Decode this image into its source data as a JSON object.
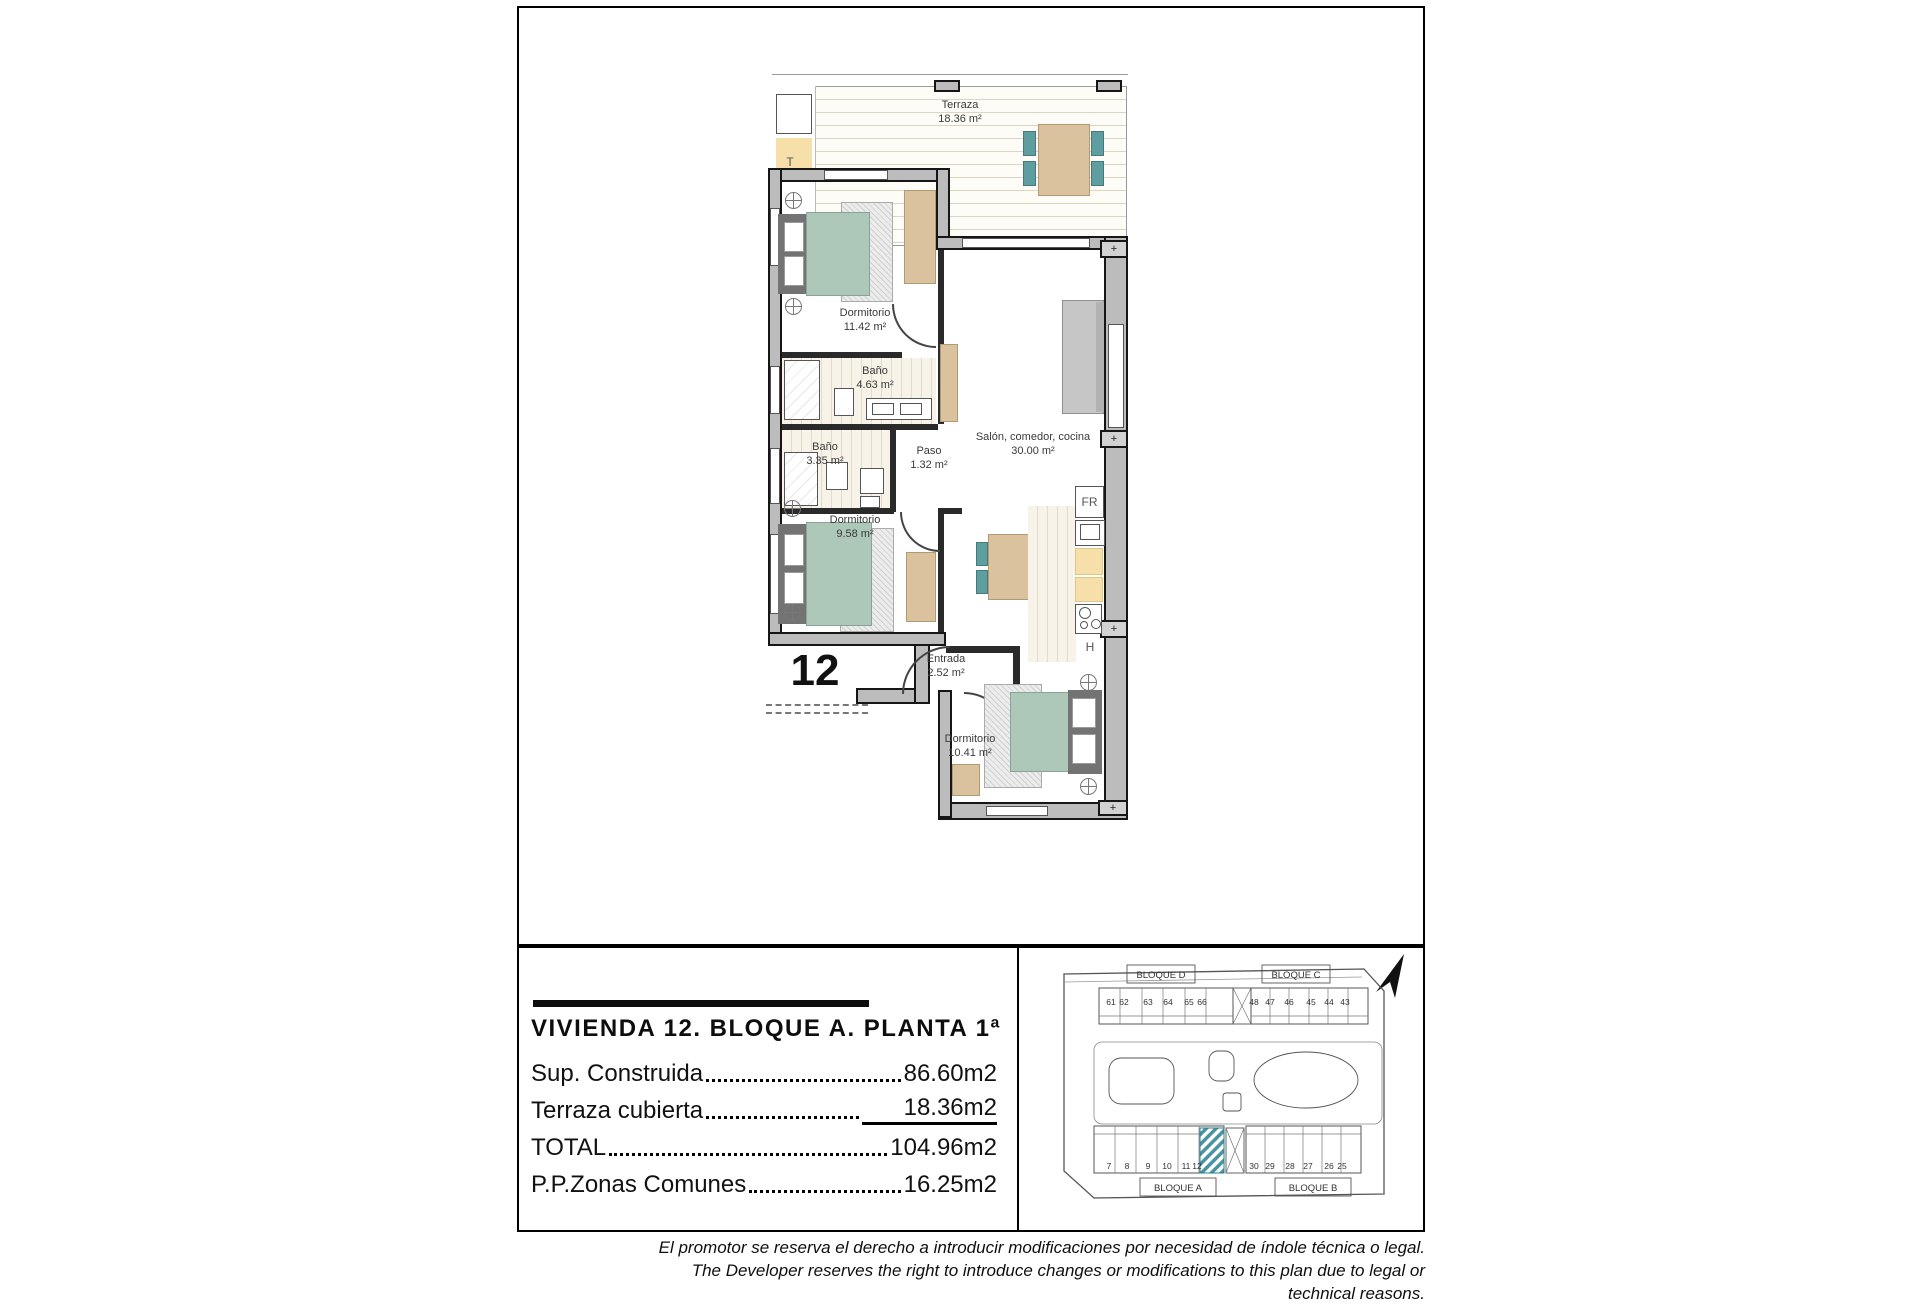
{
  "plan": {
    "unit_number": "12",
    "rooms": {
      "terraza": {
        "name": "Terraza",
        "area": "18.36 m²"
      },
      "dormitorio1": {
        "name": "Dormitorio",
        "area": "11.42 m²"
      },
      "bano1": {
        "name": "Baño",
        "area": "4.63 m²"
      },
      "bano2": {
        "name": "Baño",
        "area": "3.35 m²"
      },
      "paso": {
        "name": "Paso",
        "area": "1.32 m²"
      },
      "salon": {
        "name": "Salón, comedor, cocina",
        "area": "30.00 m²"
      },
      "dormitorio2": {
        "name": "Dormitorio",
        "area": "9.58 m²"
      },
      "entrada": {
        "name": "Entrada",
        "area": "2.52 m²"
      },
      "dormitorio3": {
        "name": "Dormitorio",
        "area": "10.41 m²"
      }
    },
    "labels": {
      "terrace": "T",
      "fridge": "FR",
      "hob": "H"
    },
    "pillar_symbol": "+",
    "colors": {
      "bed_teal": "#adc8b9",
      "chair_teal": "#5f9ea0",
      "furniture_tan": "#dbc29e",
      "counter_yellow": "#f6dfa8"
    }
  },
  "info_panel": {
    "title": "VIVIENDA 12. BLOQUE A. PLANTA 1ª",
    "rows": [
      {
        "label": "Sup. Construida",
        "value": "86.60m2"
      },
      {
        "label": "Terraza cubierta",
        "value": "18.36m2"
      },
      {
        "label": "TOTAL",
        "value": "104.96m2"
      },
      {
        "label": "P.P.Zonas Comunes",
        "value": "16.25m2"
      }
    ]
  },
  "site_plan": {
    "bloque_d": {
      "label": "BLOQUE D",
      "units": [
        "61",
        "62",
        "63",
        "64",
        "65",
        "66"
      ]
    },
    "bloque_c": {
      "label": "BLOQUE C",
      "units": [
        "48",
        "47",
        "46",
        "45",
        "44",
        "43"
      ]
    },
    "bloque_a": {
      "label": "BLOQUE A",
      "units": [
        "7",
        "8",
        "9",
        "10",
        "11",
        "12"
      ]
    },
    "bloque_b": {
      "label": "BLOQUE B",
      "units": [
        "30",
        "29",
        "28",
        "27",
        "26",
        "25"
      ]
    },
    "highlight_color": "#4993a3"
  },
  "disclaimer": {
    "line1": "El promotor se reserva el derecho a introducir modificaciones por necesidad de índole técnica o legal.",
    "line2": "The Developer reserves the right to introduce changes or modifications to this plan due to legal or technical reasons."
  }
}
